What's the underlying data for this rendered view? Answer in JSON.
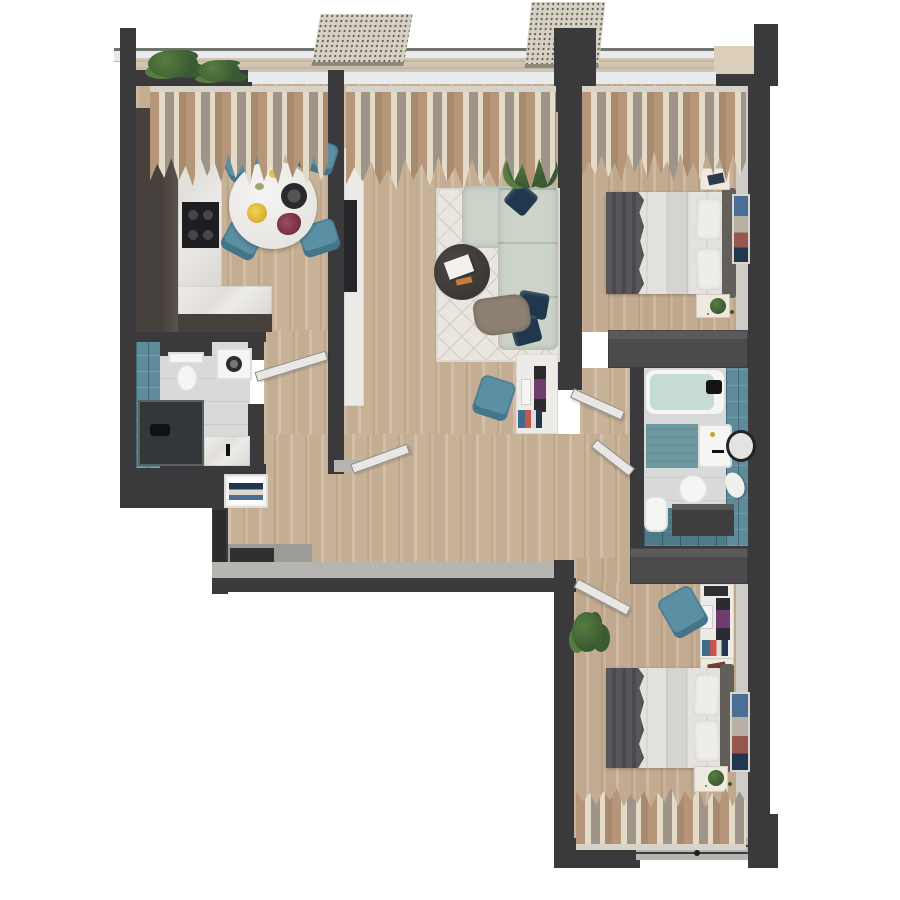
{
  "scene": {
    "label": "Top-down 3D render of a two-bedroom apartment floor plan",
    "background": "#ffffff"
  },
  "palette": {
    "wall": "#3a3a3c",
    "wall-deep": "#2c2c2e",
    "wall-cap": "#b7b5b1",
    "partition": "#55555",
    "inner-face": "#cfccc8",
    "threshold": "#b6b5b2",
    "glass": "#e8ebee",
    "railing": "#70746b",
    "balcony": "#cfc5b2",
    "parapet": "#dbcfba",
    "awning": "#d6d0c2",
    "awning-dot": "#55534b",
    "curtain-a": "#b69678",
    "curtain-b": "#e3dac8",
    "curtain-c": "#9e9588",
    "marble": "#eceae6",
    "cabinet": "#46413c",
    "cabinet-2": "#5a534b",
    "cooktop": "#1e1e20",
    "table": "#f1f0ed",
    "chair": "#5b8fa3",
    "chair-dark": "#44758a",
    "sofa": "#ccd3c9",
    "sofa-line": "#b3bcb0",
    "navy": "#20374d",
    "rug": "#eae6df",
    "rug-line": "#d0cbc2",
    "coffee": "#3b3836",
    "throw-sofa": "#8d8174",
    "plant": "#3a5a32",
    "plant-2": "#567e40",
    "panel-white": "#eceae6",
    "tv": "#26262a",
    "desk": "#edebe7",
    "monitor": "#2b2b31",
    "screen": "#6e3d6e",
    "tile": "#5d8b99",
    "tile-deep": "#4c7a89",
    "bath-floor": "#d8dad9",
    "water": "#c6dbd4",
    "mat": "#6e98a0",
    "porcelain": "#f5f5f3",
    "wardrobe": "#4b4b4d",
    "linen": "#e4e2de",
    "linen-2": "#d6d4cf",
    "bed-throw": "#57575b",
    "headboard": "#625e5a",
    "stand": "#efe9df",
    "entry-floor": "#9c9b97",
    "doormat": "#303032",
    "art-a": "#4a6e96",
    "art-b": "#b8b0a4",
    "art-c": "#97564e",
    "book-a": "#3f6b8c",
    "book-b": "#c2574f",
    "book-c": "#e0ddd6"
  },
  "rooms": [
    {
      "name": "kitchen-dining",
      "furniture": [
        "tall-cabinets",
        "countertop",
        "cooktop",
        "round-dining-table",
        "four-teal-chairs",
        "window-curtains"
      ]
    },
    {
      "name": "living-room",
      "furniture": [
        "corner-sofa",
        "navy-pillows",
        "coffee-table",
        "geometric-rug",
        "tv-wall",
        "desk-with-monitor",
        "teal-desk-chair",
        "plant",
        "storage-partition"
      ]
    },
    {
      "name": "bedroom-1",
      "furniture": [
        "double-bed",
        "gray-throw",
        "two-nightstands",
        "wardrobe",
        "wall-art",
        "window-curtains"
      ]
    },
    {
      "name": "bathroom-1",
      "furniture": [
        "toilet",
        "washing-machine",
        "shower",
        "sink-counter",
        "teal-tile-wall"
      ]
    },
    {
      "name": "bathroom-2",
      "furniture": [
        "bathtub",
        "sink",
        "round-mirror",
        "toilet",
        "bidet",
        "dark-vanity",
        "teal-tile-wall",
        "bath-mat"
      ]
    },
    {
      "name": "bedroom-2",
      "furniture": [
        "double-bed",
        "gray-throw",
        "desk-with-monitor",
        "teal-desk-chair",
        "wardrobe",
        "nightstand",
        "wall-art",
        "plant",
        "window-curtains"
      ]
    },
    {
      "name": "hallway-entry",
      "furniture": [
        "entry-door",
        "doormat",
        "open-shelf-closet"
      ]
    },
    {
      "name": "balcony",
      "furniture": [
        "glass-railing",
        "perforated-awnings",
        "plants"
      ]
    }
  ]
}
